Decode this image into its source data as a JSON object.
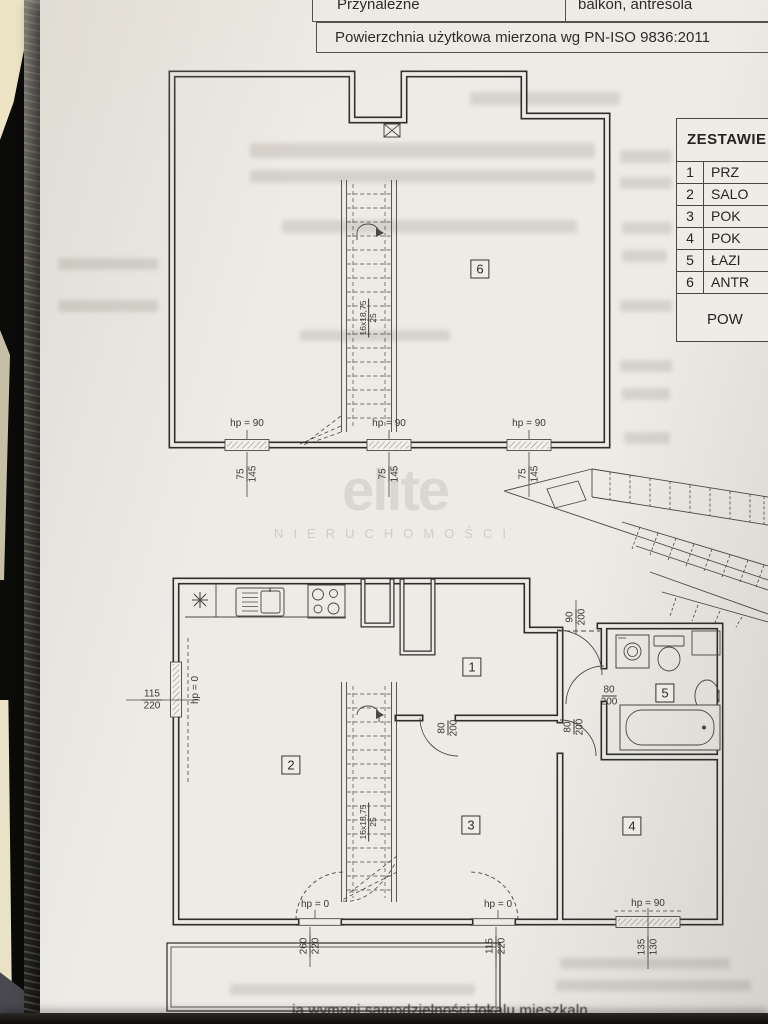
{
  "top_table": {
    "attribute_label": "Przynależne",
    "attribute_value": "balkon, antresola",
    "note": "Powierzchnia użytkowa mierzona wg PN-ISO 9836:2011"
  },
  "legend_table": {
    "title": "ZESTAWIE",
    "rows": [
      {
        "no": "1",
        "name": "PRZ"
      },
      {
        "no": "2",
        "name": "SALO"
      },
      {
        "no": "3",
        "name": "POK"
      },
      {
        "no": "4",
        "name": "POK"
      },
      {
        "no": "5",
        "name": "ŁAZI"
      },
      {
        "no": "6",
        "name": "ANTR"
      }
    ],
    "footer": "POW"
  },
  "watermark": {
    "brand": "elite",
    "subtitle": "NIERUCHOMOŚCI"
  },
  "icons": {
    "kitchen": "asterisk-symbol",
    "roof_hatch": "x-box-symbol"
  },
  "upper_plan": {
    "room_number": "6",
    "stairs_label_top": "16x18,75",
    "stairs_label_bottom": "25",
    "windows": [
      {
        "hp": "hp = 90",
        "dim_a": "75",
        "dim_b": "145"
      },
      {
        "hp": "hp = 90",
        "dim_a": "75",
        "dim_b": "145"
      },
      {
        "hp": "hp = 90",
        "dim_a": "75",
        "dim_b": "145"
      }
    ]
  },
  "lower_plan": {
    "room_numbers": {
      "hall": "1",
      "living": "2",
      "room3": "3",
      "room4": "4",
      "bath": "5"
    },
    "stairs_label_top": "16x18,75",
    "stairs_label_bottom": "25",
    "left_window": {
      "dim_a": "115",
      "dim_b": "220",
      "hp": "hp = 0"
    },
    "entrance_door": {
      "dim_a": "90",
      "dim_b": "200"
    },
    "bath_door": {
      "dim_a": "80",
      "dim_b": "200"
    },
    "room4_door": {
      "dim_a": "80",
      "dim_b": "200"
    },
    "room3_door": {
      "dim_a": "80",
      "dim_b": "200"
    },
    "balcony_door_left": {
      "hp": "hp = 0",
      "dim_a": "260",
      "dim_b": "220"
    },
    "balcony_door_right": {
      "hp": "hp = 0",
      "dim_a": "115",
      "dim_b": "220"
    },
    "room4_window": {
      "hp": "hp = 90",
      "dim_a": "135",
      "dim_b": "130"
    }
  },
  "caption_fragment": "…ia wymogi samodzielności lokalu mieszkaln…"
}
